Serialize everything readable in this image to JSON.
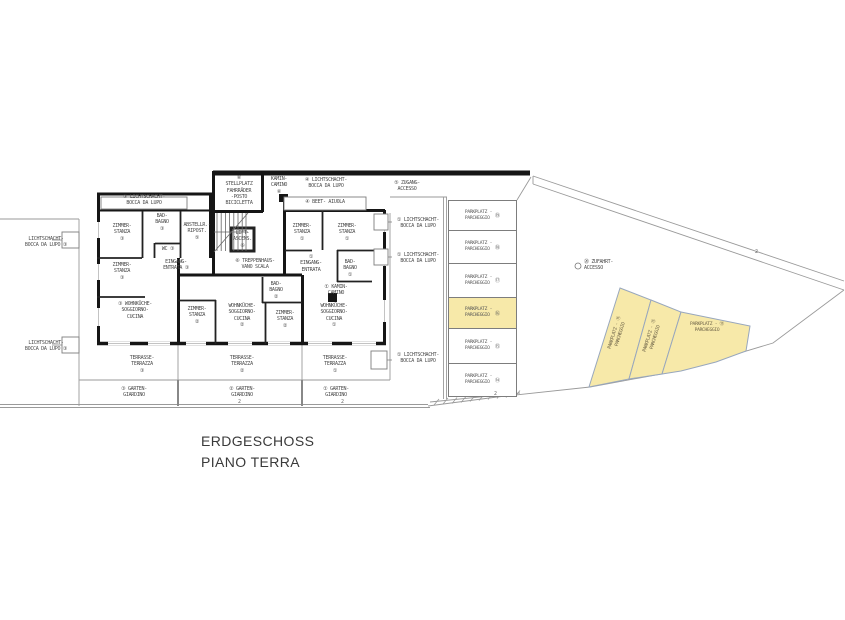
{
  "title": {
    "line1": "ERDGESCHOSS",
    "line2": "PIANO TERRA"
  },
  "colors": {
    "highlight": "#F7E9A9",
    "wall": "#161616",
    "thin_line": "#9a9a9a",
    "text": "#4a4a4a"
  },
  "plan": {
    "labels": {
      "lichtschacht_top": "③ LICHTSCHACHT-\nBOCCA DA LUPO",
      "stellplatz": "⑥\nSTELLPLATZ\nFAHRRÄDER\n-POSTO\nBICICLETTA",
      "kamin_top": "KAMIN-\nCAMINO\n⑥",
      "lichtschacht_top2": "④ LICHTSCHACHT-\nBOCCA DA LUPO",
      "zugang": "⑤ ZUGANG-\nACCESSO",
      "beet": "④ BEET-  AIUOLA",
      "zimmer3a": "ZIMMER-\nSTANZA\n③",
      "bad3": "BAD-\nBAGNO\n③",
      "wc3": "WC ③",
      "abstellraum": "ABSTELLR.-\nRIPOST.\n⑤",
      "lift": "LIFT-\nASCENS.\n⑥",
      "zimmer3b": "ZIMMER-\nSTANZA\n③",
      "eingang3": "EINGANG-\nENTRATA ③",
      "treppenhaus": "⑥ TREPPENHAUS-\nVANO SCALA",
      "wohnkueche3": "③ WOHNKÜCHE-\nSOGGIORNO-\nCUCINA",
      "zimmer2a": "ZIMMER-\nSTANZA\n②",
      "wohnkueche2": "WOHNKÜCHE-\nSOGGIORNO-\nCUCINA\n②",
      "bad2": "BAD-\nBAGNO\n②",
      "zimmer2b": "ZIMMER-\nSTANZA\n②",
      "zimmer1a": "ZIMMER-\nSTANZA\n①",
      "zimmer1b": "ZIMMER-\nSTANZA\n①",
      "eingang1": "①\nEINGANG-\nENTRATA",
      "bad1": "BAD-\nBAGNO\n①",
      "kamin1": "① KAMIN-\nCAMINO",
      "wohnkueche1": "WOHNKÜCHE-\nSOGGIORNO-\nCUCINA\n①",
      "terrasse3": "TERRASSE-\nTERRAZZA\n③",
      "terrasse2": "TERRASSE-\nTERRAZZA\n②",
      "terrasse1": "TERRASSE-\nTERRAZZA\n①",
      "garten3": "③ GARTEN-\nGIARDINO",
      "garten2": "② GARTEN-\nGIARDINO",
      "garten1": "① GARTEN-\nGIARDINO",
      "lichtschacht_left1": "LICHTSCHACHT-\nBOCCA DA LUPO ③",
      "lichtschacht_left2": "LICHTSCHACHT-\nBOCCA DA LUPO ③",
      "lichtschacht_right1": "① LICHTSCHACHT-\nBOCCA DA LUPO",
      "lichtschacht_right2": "① LICHTSCHACHT-\nBOCCA DA LUPO",
      "lichtschacht_right3": "① LICHTSCHACHT-\nBOCCA DA LUPO"
    }
  },
  "parking": {
    "zufahrt": "⑳ ZUFAHRT-\nACCESSO",
    "stalls": [
      {
        "label": "PARKPLATZ -\nPARCHEGGIO",
        "num": "⑲",
        "highlighted": false
      },
      {
        "label": "PARKPLATZ -\nPARCHEGGIO",
        "num": "⑱",
        "highlighted": false
      },
      {
        "label": "PARKPLATZ -\nPARCHEGGIO",
        "num": "⑰",
        "highlighted": false
      },
      {
        "label": "PARKPLATZ -\nPARCHEGGIO",
        "num": "⑯",
        "highlighted": true
      },
      {
        "label": "PARKPLATZ -\nPARCHEGGIO",
        "num": "⑮",
        "highlighted": false
      },
      {
        "label": "PARKPLATZ -\nPARCHEGGIO",
        "num": "⑭",
        "highlighted": false
      }
    ],
    "diagonal": [
      {
        "label": "PARKPLATZ - ⑪\nPARCHEGGIO"
      },
      {
        "label": "PARKPLATZ - ⑫\nPARCHEGGIO"
      },
      {
        "label": "PARKPLATZ - ⑬\nPARCHEGGIO"
      }
    ]
  },
  "marks": {
    "m1": "2",
    "m2": "2",
    "m3": "2",
    "m4": "2"
  }
}
